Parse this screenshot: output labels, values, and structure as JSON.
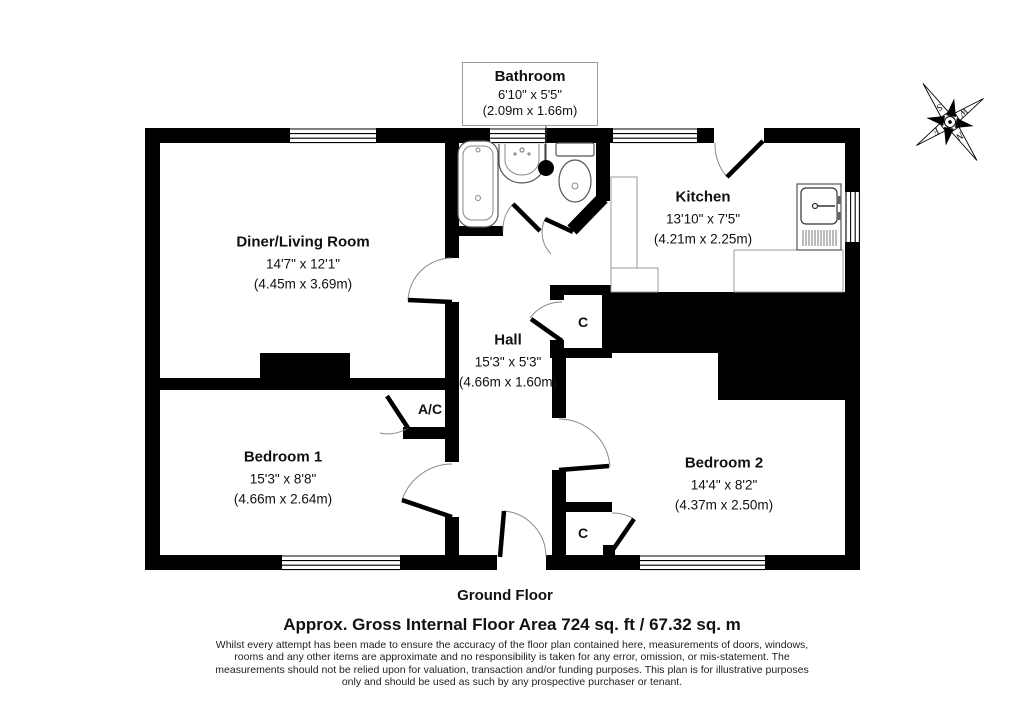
{
  "page": {
    "background": "#ffffff"
  },
  "colors": {
    "wall": "#000000",
    "door_arc": "#888888",
    "fixture_outline": "#555555",
    "callout_border": "#999999"
  },
  "rooms": {
    "diner_living": {
      "name": "Diner/Living Room",
      "imperial": "14'7\" x 12'1\"",
      "metric": "(4.45m x 3.69m)"
    },
    "kitchen": {
      "name": "Kitchen",
      "imperial": "13'10\" x 7'5\"",
      "metric": "(4.21m x 2.25m)"
    },
    "hall": {
      "name": "Hall",
      "imperial": "15'3\" x 5'3\"",
      "metric": "(4.66m x 1.60m)"
    },
    "bedroom1": {
      "name": "Bedroom 1",
      "imperial": "15'3\" x 8'8\"",
      "metric": "(4.66m x 2.64m)"
    },
    "bedroom2": {
      "name": "Bedroom 2",
      "imperial": "14'4\" x 8'2\"",
      "metric": "(4.37m x 2.50m)"
    },
    "bathroom": {
      "name": "Bathroom",
      "imperial": "6'10\" x 5'5\"",
      "metric": "(2.09m x 1.66m)"
    }
  },
  "closets": {
    "air_conditioning": "A/C",
    "hall_closet": "C",
    "bedroom2_closet": "C"
  },
  "compass": {
    "north": "N",
    "east": "E",
    "south": "S",
    "west": "W"
  },
  "footer": {
    "floor_label": "Ground Floor",
    "area_label": "Approx. Gross Internal Floor Area 724 sq. ft / 67.32 sq. m",
    "disclaimer": [
      "Whilst every attempt has been made to ensure the accuracy of the floor plan contained here, measurements of doors, windows,",
      "rooms and any other items are approximate and no responsibility is taken for any error, omission, or mis-statement. The",
      "measurements should not be relied upon for valuation, transaction and/or funding purposes. This plan is for illustrative purposes",
      "only and should be used as such by any prospective purchaser or tenant."
    ]
  }
}
